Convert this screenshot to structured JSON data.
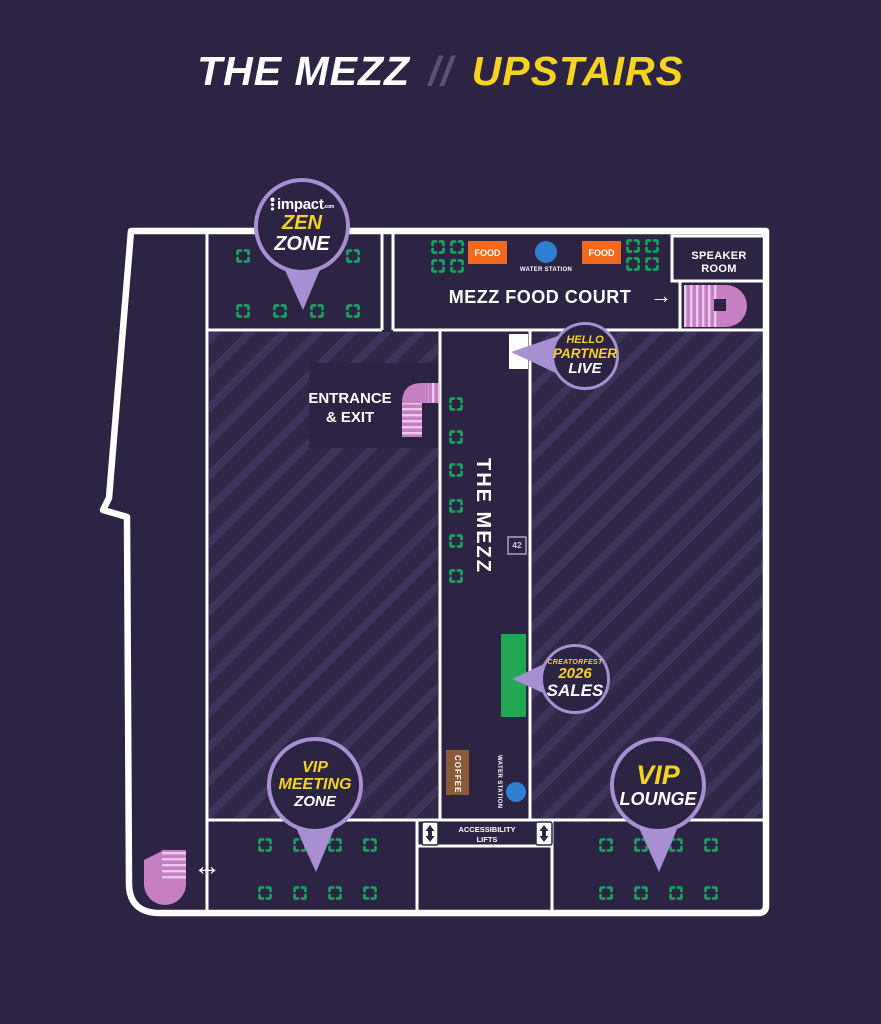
{
  "title": {
    "main": "THE MEZZ",
    "sep": "//",
    "accent": "UPSTAIRS"
  },
  "rooms": {
    "speaker_room": "SPEAKER ROOM",
    "food_court": "MEZZ FOOD COURT",
    "food_court_arrow": "→",
    "entrance_line1": "ENTRANCE",
    "entrance_line2": "& EXIT",
    "corridor_name": "THE MEZZ",
    "booth_number": "42",
    "lifts_line1": "ACCESSIBILITY",
    "lifts_line2": "LIFTS",
    "coffee": "COFFEE",
    "water_station": "WATER STATION",
    "food": "FOOD",
    "exchange_arrow": "↔"
  },
  "pins": {
    "zen": {
      "logo_text": "impact",
      "logo_suffix": ".com",
      "line1": "ZEN",
      "line2": "ZONE"
    },
    "hello": {
      "line1": "HELLO",
      "line2": "PARTNER",
      "line3": "LIVE"
    },
    "sales": {
      "line1": "CREATORFEST",
      "line2": "2026",
      "line3": "SALES"
    },
    "vip_meeting": {
      "line1": "VIP",
      "line2": "MEETING",
      "line3": "ZONE"
    },
    "vip_lounge": {
      "line1": "VIP",
      "line2": "LOUNGE"
    }
  },
  "colors": {
    "background": "#2d2343",
    "accent_yellow": "#f5d321",
    "pin_purple": "#a78fd2",
    "marker_green": "#17a15e",
    "booth_green": "#22a855",
    "food_orange": "#f2691d",
    "water_blue": "#2e7fd0",
    "coffee_brown": "#8a5a39",
    "stairs_pink": "#c77fc4",
    "wall_white": "#ffffff"
  },
  "markers": {
    "positions": [
      [
        243,
        256
      ],
      [
        353,
        256
      ],
      [
        243,
        311
      ],
      [
        280,
        311
      ],
      [
        317,
        311
      ],
      [
        353,
        311
      ],
      [
        438,
        247
      ],
      [
        457,
        247
      ],
      [
        438,
        266
      ],
      [
        457,
        266
      ],
      [
        633,
        246
      ],
      [
        652,
        246
      ],
      [
        633,
        264
      ],
      [
        652,
        264
      ],
      [
        456,
        404
      ],
      [
        456,
        437
      ],
      [
        456,
        470
      ],
      [
        456,
        506
      ],
      [
        456,
        541
      ],
      [
        456,
        576
      ],
      [
        265,
        845
      ],
      [
        300,
        845
      ],
      [
        335,
        845
      ],
      [
        370,
        845
      ],
      [
        265,
        893
      ],
      [
        300,
        893
      ],
      [
        335,
        893
      ],
      [
        370,
        893
      ],
      [
        606,
        845
      ],
      [
        641,
        845
      ],
      [
        676,
        845
      ],
      [
        711,
        845
      ],
      [
        606,
        893
      ],
      [
        641,
        893
      ],
      [
        676,
        893
      ],
      [
        711,
        893
      ]
    ]
  }
}
